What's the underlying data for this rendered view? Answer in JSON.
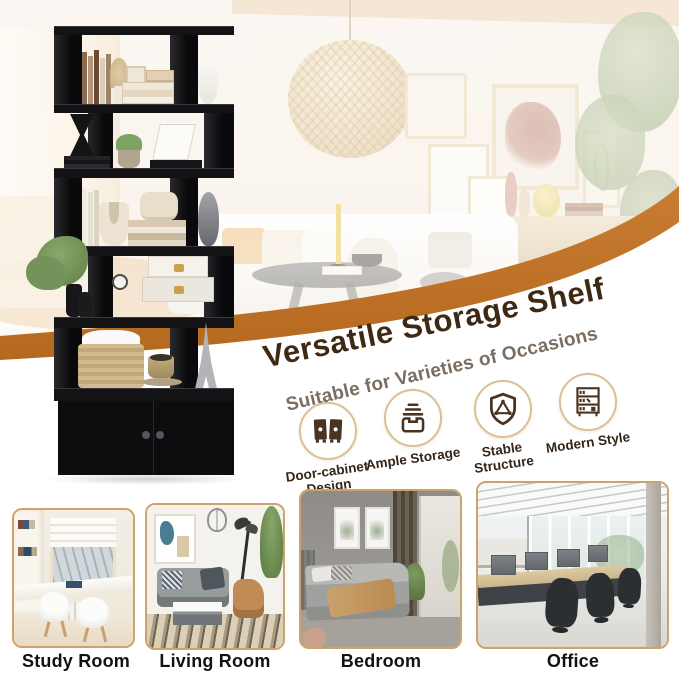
{
  "hero": {
    "title": "Versatile Storage Shelf",
    "subtitle": "Suitable for Varieties of Occasions"
  },
  "features": [
    {
      "label": "Door-cabinet Design",
      "icon": "door-cabinet-icon"
    },
    {
      "label": "Ample Storage",
      "icon": "storage-drawer-icon"
    },
    {
      "label": "Stable Structure",
      "icon": "shield-triangle-icon"
    },
    {
      "label": "Modern Style",
      "icon": "bookshelf-icon"
    }
  ],
  "occasions": [
    {
      "label": "Study Room",
      "photo": "study-room-photo"
    },
    {
      "label": "Living Room",
      "photo": "living-room-photo"
    },
    {
      "label": "Bedroom",
      "photo": "bedroom-photo"
    },
    {
      "label": "Office",
      "photo": "office-photo"
    }
  ],
  "colors": {
    "swoosh": "#C0722A",
    "title": "#3E2A14",
    "subtitle": "#7A6E63",
    "feature_ring": "#DCBF97",
    "feature_icon": "#4A3421",
    "feature_label": "#34261A",
    "card_border": "#CDA36A",
    "card_label": "#121212",
    "shelf": "#0E0E10"
  }
}
